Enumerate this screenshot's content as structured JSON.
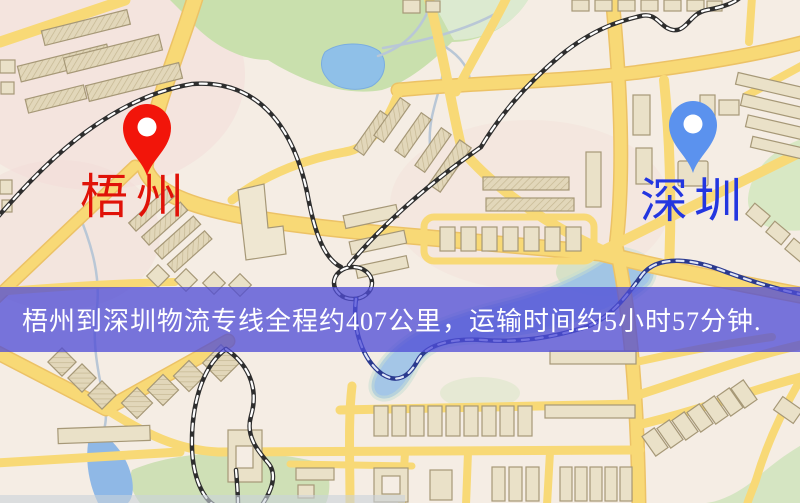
{
  "banner": {
    "text": "梧州到深圳物流专线全程约407公里，运输时间约5小时57分钟.",
    "bg_color": "#4f4cd6",
    "text_color": "#ffffff"
  },
  "markers": {
    "origin": {
      "name": "梧州",
      "pin_color": "#f2150a",
      "label_color": "#e01208"
    },
    "destination": {
      "name": "深圳",
      "pin_color": "#5b92ee",
      "label_color": "#2336e0"
    }
  },
  "route": {
    "origin": "梧州",
    "destination": "深圳",
    "distance": "约407公里",
    "duration": "约5小时57分钟"
  },
  "map_palette": {
    "background": "#f5ede4",
    "road": "#f8d976",
    "park": "#c9e0ad",
    "water": "#8fc0e8",
    "railway": "#2e2e2e"
  }
}
